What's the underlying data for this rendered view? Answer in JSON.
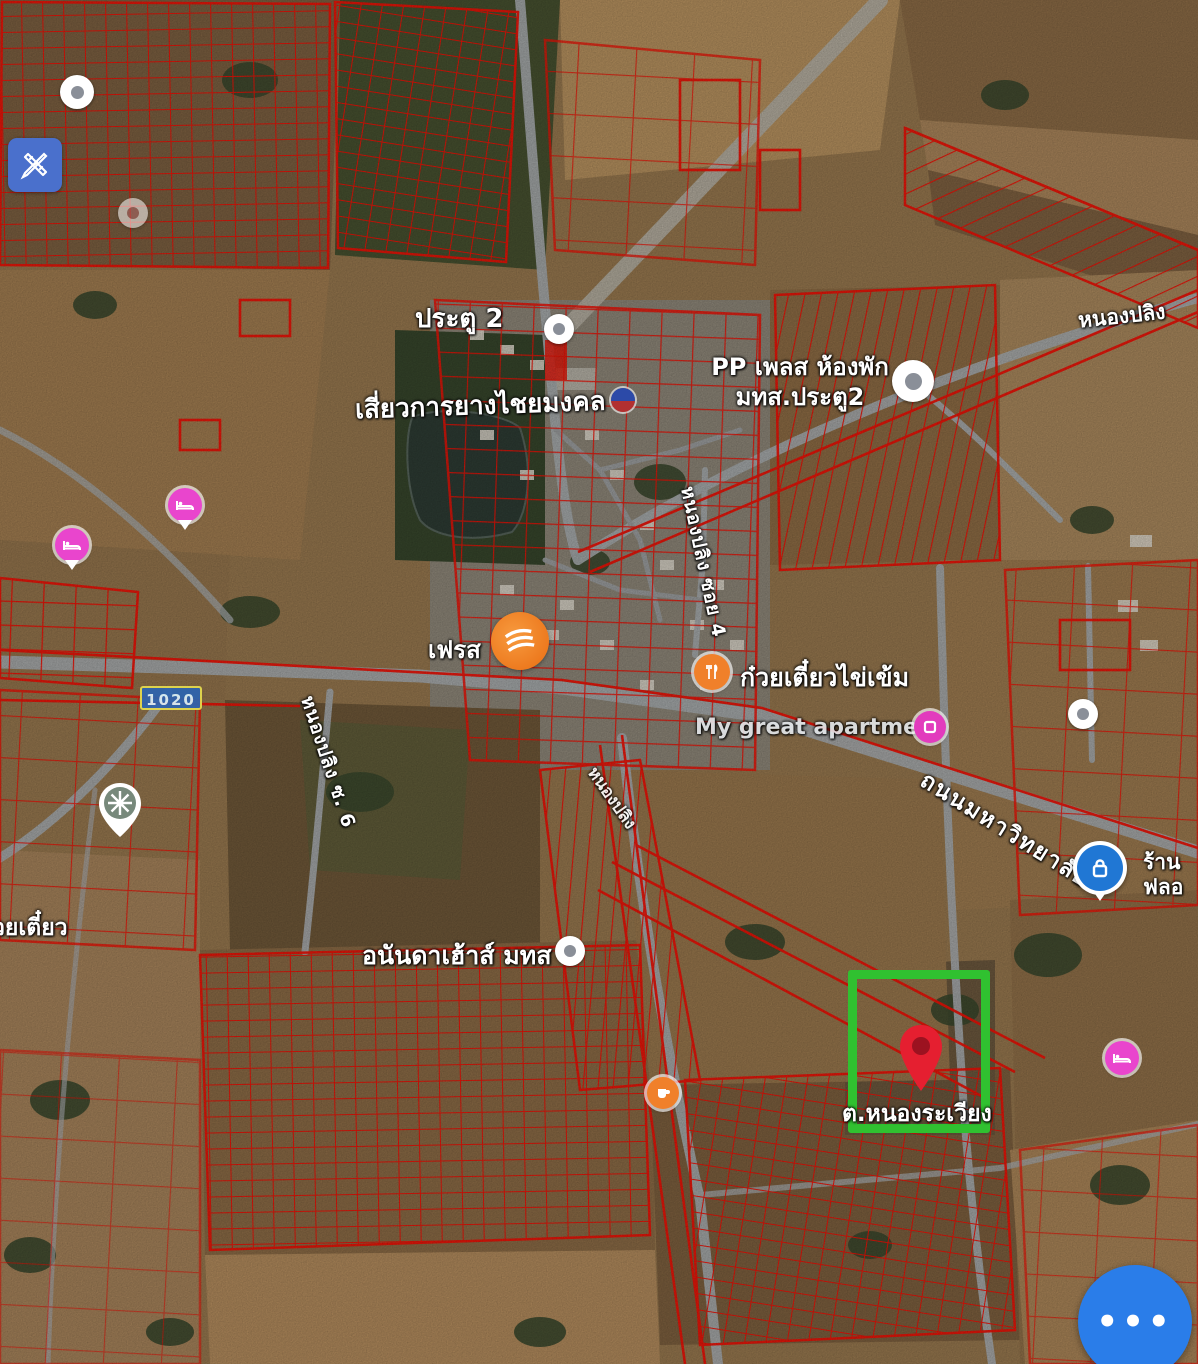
{
  "app": {
    "type": "satellite-map-with-parcel-overlay"
  },
  "colors": {
    "parcel_outline_red": "#ee1207",
    "highlight_green": "#30c130",
    "fab_blue": "#2a7de9",
    "edit_button_blue": "#4a70cc",
    "route_badge_blue": "#2f64ad",
    "route_badge_border_yellow": "#e3d94f",
    "destination_pin_red": "#e51f30",
    "lodging_pin_pink": "#e945cd",
    "poi_orange": "#f0802a",
    "lock_pin_blue": "#2077d4",
    "road_gray": "#a6aaac"
  },
  "route_badge": {
    "text": "1020"
  },
  "fab": {
    "more_options_glyph": "•••"
  },
  "labels": {
    "portal2": "ประตู 2",
    "rubber_shop": "เสี่ยวการยางไชยมงคล",
    "pp_place_line1": "PP เพลส ห้องพัก",
    "pp_place_line2": "มทส.ประตู2",
    "nongpling_top": "หนองปลิง",
    "fresh_mart": "เฟรส",
    "noodle_shop": "ก๋วยเตี๋ยวไข่เข้ม",
    "my_great": "My great apartment",
    "university_road": "ถนนมหาวิทยาลัย",
    "ran_flo_line1": "ร้าน",
    "ran_flo_line2": "ฟลอ",
    "ananda_house": "อนันดาเฮ้าส์ มทส",
    "nong_rawiang": "ต.หนองระเวียง",
    "kuayteow_left": "วยเตี๋ยว",
    "soi4": "หนองปลิง ซอย 4",
    "soi6": "หนองปลิง ซ. 6",
    "soi_mid": "หนองปลิง"
  },
  "icons": {
    "edit_tools": "pencil-and-ruler",
    "generic_place_dot": "white-circle-gray-dot",
    "lodging": "bed-in-pink-circle",
    "restaurant": "fork-knife-in-orange-circle",
    "supermarket_logo": "orange-circle-logo",
    "cafe": "cup-in-orange-circle",
    "store": "square-in-pink-circle",
    "temple_wheel": "wheel-in-gray-pin",
    "lock_shop": "padlock-in-blue-circle",
    "destination": "red-map-pin",
    "more_options": "three-dots"
  }
}
